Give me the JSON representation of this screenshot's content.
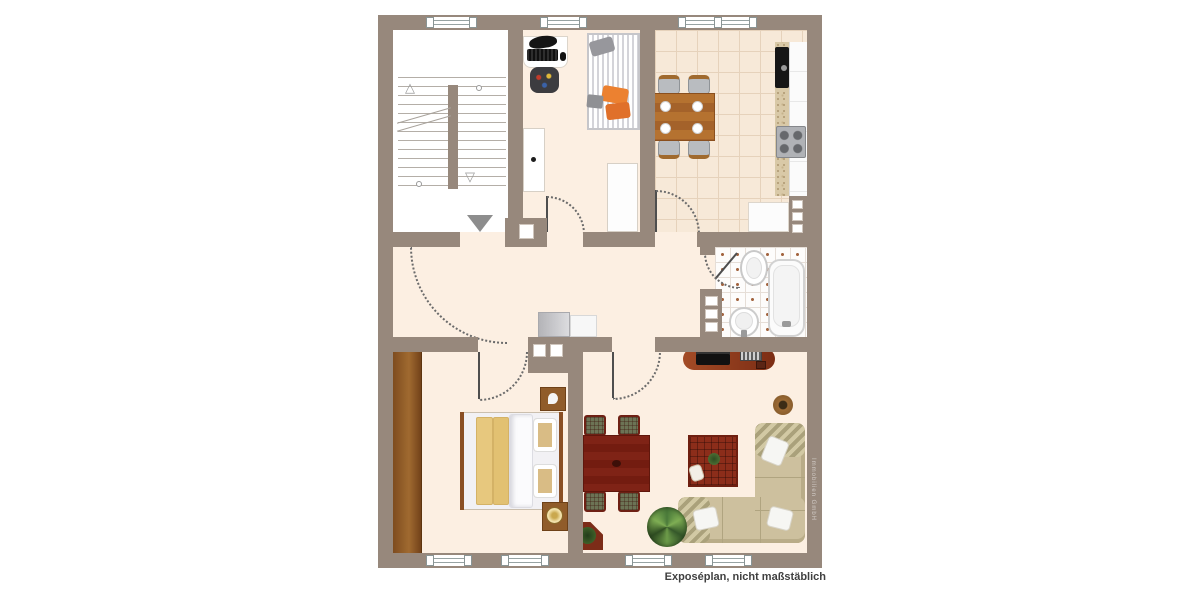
{
  "caption": "Exposéplan, nicht maßstäblich",
  "watermark": "Immobilien GmbH",
  "plan_type": "apartment-floorplan",
  "palette": {
    "wall": "#97887c",
    "floor_cream": "#fcefe2",
    "kitchen_tile": "#f7e9d8",
    "bath_tile": "#fdfcfb",
    "wood_light": "#a06a30",
    "wood_kitchen_table": "#b06d2d",
    "mahogany": "#7c2114",
    "rust_sideboard": "#9a4626",
    "rug_red": "#8c2d1a",
    "sofa_beige": "#cdc09e",
    "blanket_yellow": "#e7c87e",
    "accent_orange": "#ec8130"
  },
  "rooms": [
    {
      "name": "stairwell",
      "items": [
        "staircase-double-flight",
        "up-arrow",
        "down-arrow",
        "entrance-arrow"
      ]
    },
    {
      "name": "study",
      "items": [
        "desk-with-keyboard-and-headset",
        "office-chair",
        "striped-daybed",
        "tall-cabinet",
        "white-cabinet"
      ]
    },
    {
      "name": "kitchen",
      "items": [
        "wooden-dining-table",
        "four-chairs",
        "four-plates",
        "black-sink",
        "stove",
        "speckled-countertop",
        "white-cabinets",
        "wall-niche-shelf"
      ]
    },
    {
      "name": "hallway",
      "items": [
        "sideboard",
        "entry-door-arc",
        "chimney-flues"
      ]
    },
    {
      "name": "bathroom",
      "items": [
        "toilet",
        "washbasin",
        "bathtub",
        "wall-niche-shelf"
      ]
    },
    {
      "name": "bedroom",
      "items": [
        "double-bed",
        "two-yellow-blankets",
        "two-pillows",
        "wardrobe",
        "nightstand-top",
        "nightstand-with-lamp"
      ]
    },
    {
      "name": "living-room",
      "items": [
        "mahogany-dining-table",
        "four-plaid-chairs",
        "tv-sideboard",
        "corner-sofa",
        "three-white-pillows",
        "red-rug-with-toy",
        "potted-plant",
        "round-pouf",
        "corner-table-with-plant"
      ]
    }
  ],
  "windows": {
    "top_wall": 3,
    "bottom_wall": 4
  },
  "doors": [
    "apartment-entry",
    "study",
    "kitchen",
    "bedroom",
    "living-room",
    "bathroom"
  ]
}
